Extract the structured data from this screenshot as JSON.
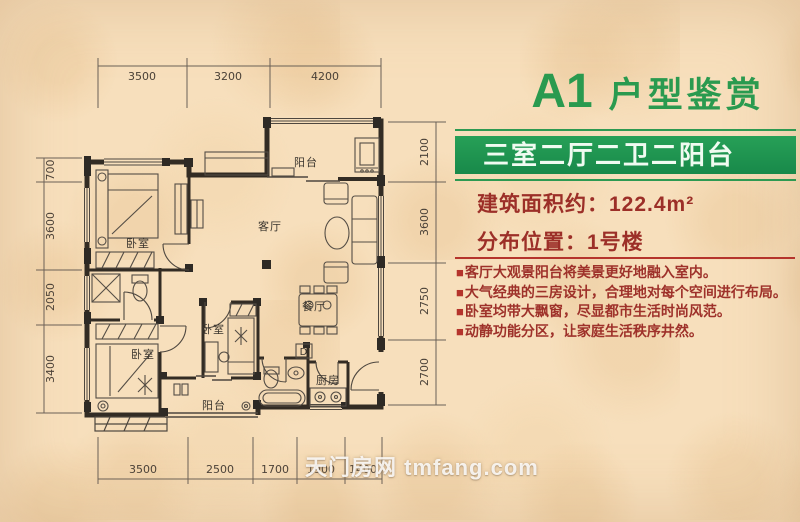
{
  "title": {
    "code": "A1",
    "name": "户型鉴赏"
  },
  "banner": {
    "text": "三室二厅二卫二阳台"
  },
  "specs": {
    "area_label": "建筑面积约：",
    "area_value": "122.4m²",
    "location_label": "分布位置：",
    "location_value": "1号楼"
  },
  "features": {
    "marker": "■",
    "items": [
      "客厅大观景阳台将美景更好地融入室内。",
      "大气经典的三房设计，合理地对每个空间进行布局。",
      "卧室均带大飘窗，尽显都市生活时尚风范。",
      "动静功能分区，让家庭生活秩序井然。"
    ]
  },
  "floorplan": {
    "labels": [
      {
        "id": "balcony-top",
        "text": "阳台"
      },
      {
        "id": "living-room",
        "text": "客厅"
      },
      {
        "id": "bedroom-1",
        "text": "卧室"
      },
      {
        "id": "bedroom-2",
        "text": "卧室"
      },
      {
        "id": "bedroom-3",
        "text": "卧室"
      },
      {
        "id": "dining-room",
        "text": "餐厅"
      },
      {
        "id": "kitchen",
        "text": "厨房"
      },
      {
        "id": "balcony-bottom",
        "text": "阳台"
      },
      {
        "id": "duct",
        "text": "D"
      }
    ],
    "dimensions": {
      "top": [
        "3500",
        "3200",
        "4200"
      ],
      "left": [
        "700",
        "3600",
        "2050",
        "3400"
      ],
      "right": [
        "2100",
        "3600",
        "2750",
        "2700"
      ],
      "bottom": [
        "3500",
        "2500",
        "1700",
        "1900",
        "1400"
      ]
    }
  },
  "watermark": {
    "site_cn": "天门房网",
    "site_en": "tmfang.com"
  },
  "colors": {
    "background": "#f7dfbc",
    "title_green": "#2a9a4f",
    "banner_green": "#1f9150",
    "text_red": "#9c2f28",
    "accent_red": "#b5342c",
    "wall": "#332c24"
  }
}
